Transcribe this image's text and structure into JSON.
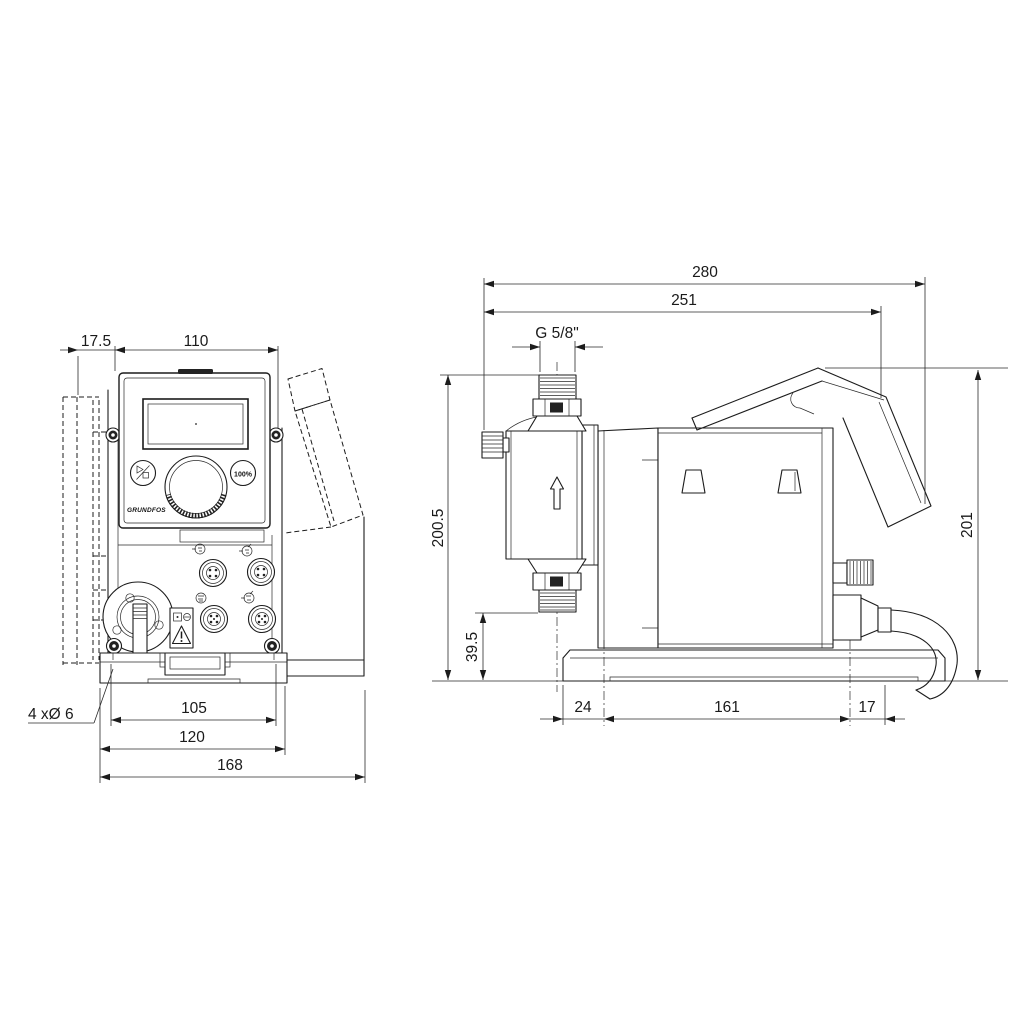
{
  "drawing": {
    "kind": "dosing-pump-dimensional-drawing",
    "front_view": {
      "dimensions": {
        "head_offset": "17.5",
        "panel_width": "110",
        "mounting_hole_spacing": "105",
        "mounting_plate_width": "120",
        "overall_width": "168"
      },
      "mounting_hole_note": "4 xØ 6",
      "control_panel": {
        "brand": "GRUNDFOS",
        "full_capacity_button": "100%"
      }
    },
    "side_view": {
      "dimensions": {
        "overall_depth": "280",
        "depth_to_control_cube": "251",
        "connection_thread": "G 5/8\"",
        "height_to_connection": "200.5",
        "valve_height": "39.5",
        "overall_height": "201",
        "front_overhang": "24",
        "mounting_hole_spacing": "161",
        "rear_overhang": "17"
      }
    }
  }
}
